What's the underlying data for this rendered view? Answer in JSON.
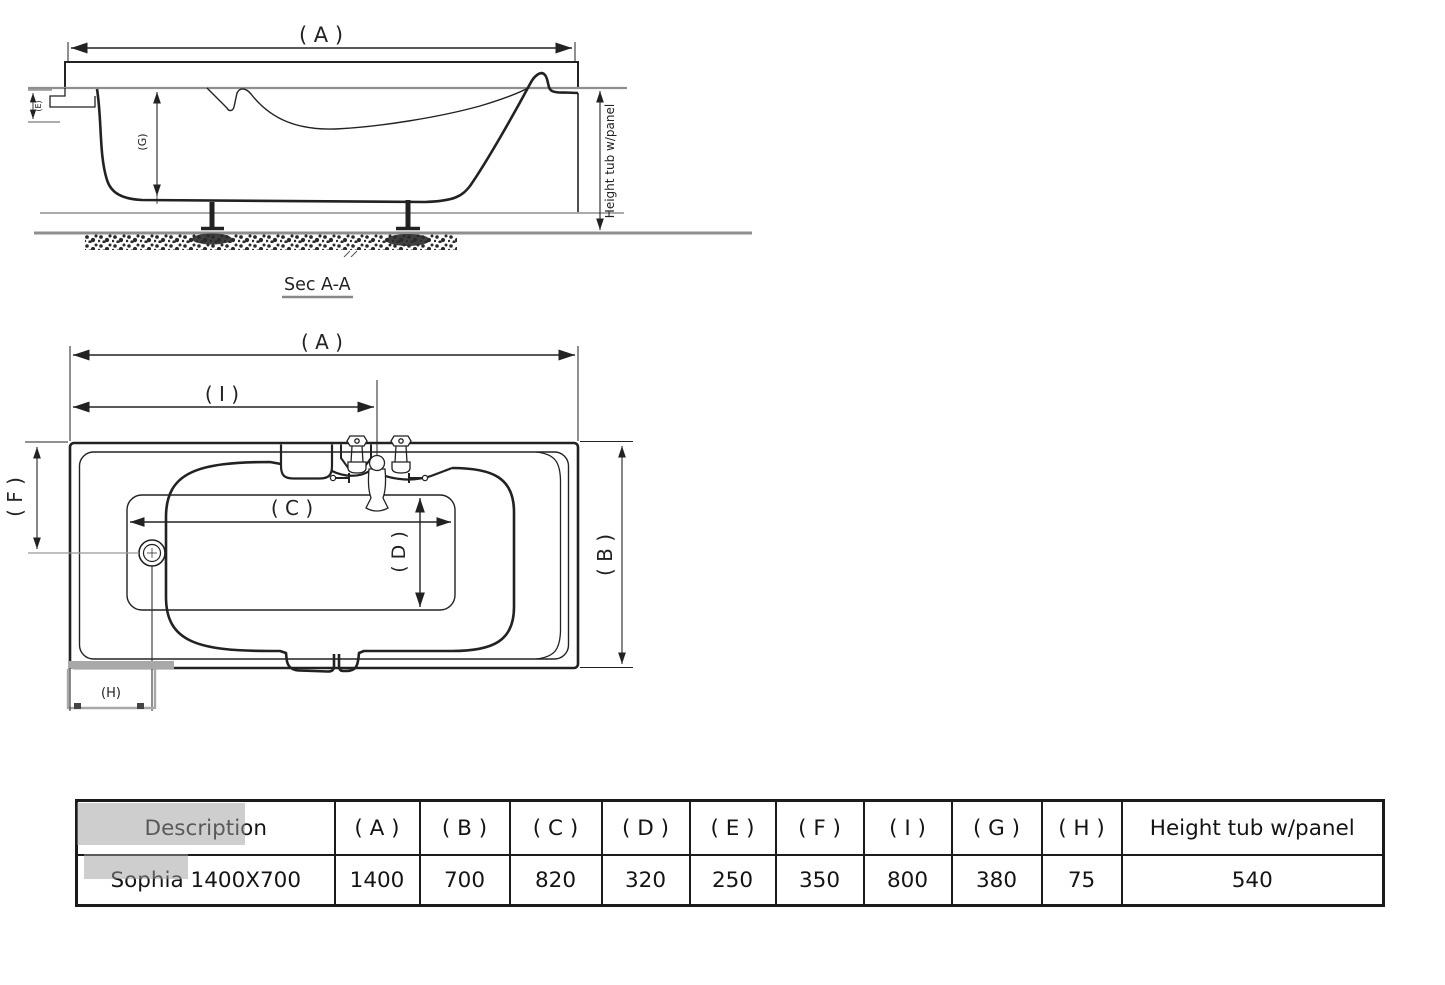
{
  "section_view": {
    "title": "Sec A-A",
    "dim_labels": {
      "a": "( A )",
      "e": "(E)",
      "g": "(G)",
      "height": "Height tub w/panel"
    }
  },
  "plan_view": {
    "dim_labels": {
      "a": "( A )",
      "i": "( I )",
      "f": "( F )",
      "c": "( C )",
      "d": "( D )",
      "b": "( B )",
      "h": "(H)"
    }
  },
  "spec_table": {
    "headers": [
      "Description",
      "( A )",
      "( B )",
      "( C )",
      "( D )",
      "( E )",
      "( F )",
      "( I )",
      "( G )",
      "( H )",
      "Height tub w/panel"
    ],
    "row": [
      "Sophia 1400X700",
      "1400",
      "700",
      "820",
      "320",
      "250",
      "350",
      "800",
      "380",
      "75",
      "540"
    ]
  },
  "colors": {
    "line": "#222222",
    "grey_line": "#8f8f8f",
    "watermark": "#a8a8a8"
  }
}
